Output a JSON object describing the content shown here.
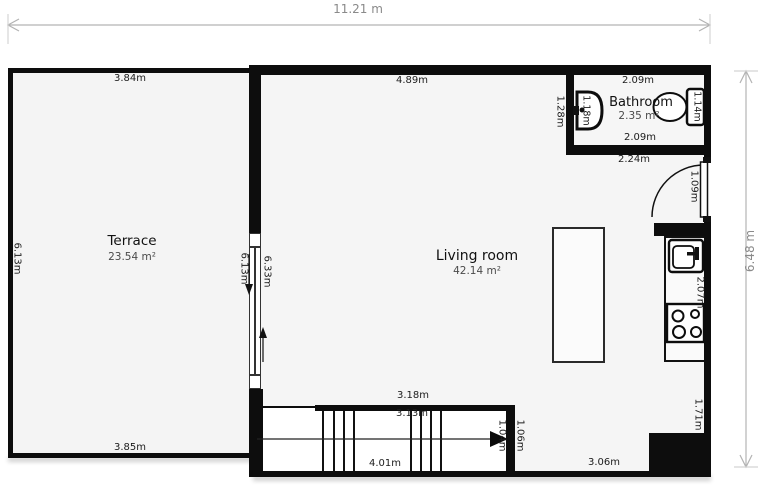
{
  "plan": {
    "overall_width": "11.21 m",
    "overall_height": "6.48 m",
    "terrace": {
      "name": "Terrace",
      "area": "23.54 m²",
      "dim_top": "3.84m",
      "dim_left": "6.13m",
      "dim_bottom": "3.85m",
      "dim_divider_terrace_side": "6.13m",
      "dim_divider_living_side": "6.33m"
    },
    "living_room": {
      "name": "Living room",
      "area": "42.14 m²",
      "dim_top": "4.89m",
      "dim_bottom_right": "3.06m"
    },
    "bathroom": {
      "name": "Bathroom",
      "area": "2.35 m²",
      "dim_top": "2.09m",
      "dim_bottom": "2.09m",
      "dim_left": "1.28m",
      "dim_sink": "1.18m",
      "dim_toilet": "1.14m",
      "dim_below_wall": "2.24m"
    },
    "entry": {
      "dim_door": "1.09m"
    },
    "kitchen": {
      "dim_upper": "2.07m",
      "dim_lower": "1.71m"
    },
    "stairs": {
      "dim_outer_top": "3.18m",
      "dim_inner_top": "3.13m",
      "dim_bottom": "4.01m",
      "dim_width_outer": "1.06m",
      "dim_width_inner": "1.04m"
    },
    "colors": {
      "wall": "#0d0d0d",
      "room_fill": "#f5f5f5",
      "dim_text": "#1c1c1c",
      "overall_dim_text": "#8a8a8a",
      "dim_line": "#b3b3b3"
    }
  }
}
